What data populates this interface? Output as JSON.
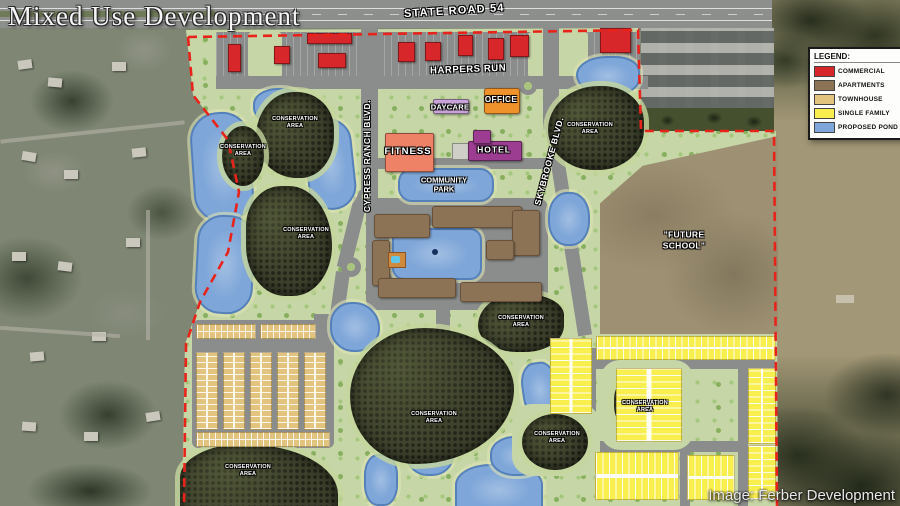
{
  "title": "Mixed Use Development",
  "attribution": "Image: Ferber Development",
  "legend": {
    "title": "LEGEND:",
    "items": [
      {
        "label": "COMMERCIAL"
      },
      {
        "label": "APARTMENTS"
      },
      {
        "label": "TOWNHOUSE"
      },
      {
        "label": "SINGLE FAMILY"
      },
      {
        "label": "PROPOSED POND"
      }
    ]
  },
  "map_colors": {
    "commercial": "#d8272b",
    "apartments": "#8c7356",
    "townhouse": "#e3c47f",
    "single_family": "#f8ee4e",
    "pond": "#7ea6d8",
    "office": "#f0922b",
    "daycare": "#c9a4d9",
    "fitness": "#ee8266",
    "hotel": "#9c3d92",
    "boundary": "#e8231a"
  },
  "roads": {
    "state_road_54": "STATE ROAD 54",
    "harpers_run": "HARPERS RUN",
    "cypress_ranch_blvd": "CYPRESS RANCH BLVD.",
    "skybrooke_blvd": "SKYBROOKE BLVD."
  },
  "places": {
    "office": "OFFICE",
    "daycare": "DAYCARE",
    "fitness": "FITNESS",
    "hotel": "HOTEL",
    "community_park": "COMMUNITY PARK",
    "future_school": "\"FUTURE SCHOOL\"",
    "conservation_area": "CONSERVATION AREA"
  }
}
